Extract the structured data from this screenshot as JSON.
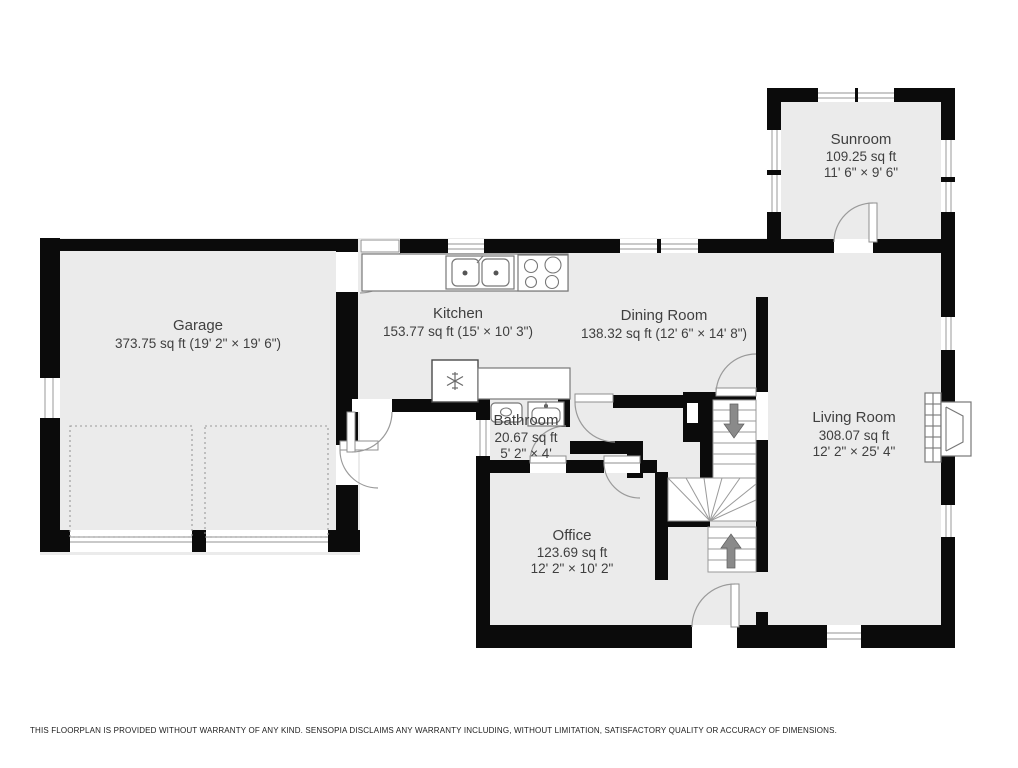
{
  "rooms": {
    "garage": {
      "name": "Garage",
      "area": "373.75 sq ft (19' 2\" × 19' 6\")"
    },
    "kitchen": {
      "name": "Kitchen",
      "area": "153.77 sq ft (15' × 10' 3\")"
    },
    "dining": {
      "name": "Dining Room",
      "area": "138.32 sq ft (12' 6\" × 14' 8\")"
    },
    "sunroom": {
      "name": "Sunroom",
      "area": "109.25 sq ft",
      "dims": "11' 6\" × 9' 6\""
    },
    "living": {
      "name": "Living Room",
      "area": "308.07 sq ft",
      "dims": "12' 2\" × 25' 4\""
    },
    "bathroom": {
      "name": "Bathroom",
      "area": "20.67 sq ft",
      "dims": "5' 2\" × 4'"
    },
    "office": {
      "name": "Office",
      "area": "123.69 sq ft",
      "dims": "12' 2\" × 10' 2\""
    }
  },
  "icons": {
    "snowflake-icon": "refrigerator",
    "double-sink-icon": "kitchen sink",
    "stove-icon": "4-burner cooktop",
    "toilet-icon": "toilet",
    "vanity-sink-icon": "bathroom sink",
    "fireplace-icon": "fireplace",
    "stairs-up-arrow-icon": "▲",
    "stairs-down-arrow-icon": "▼"
  },
  "colors": {
    "wall": "#0b0b0b",
    "floor": "#ebebeb",
    "label": "#3f3f3f",
    "arrow": "#8a8a8a"
  },
  "footer": {
    "disclaimer": "THIS FLOORPLAN IS PROVIDED WITHOUT WARRANTY OF ANY KIND. SENSOPIA DISCLAIMS ANY WARRANTY INCLUDING, WITHOUT LIMITATION, SATISFACTORY QUALITY OR ACCURACY OF DIMENSIONS."
  }
}
